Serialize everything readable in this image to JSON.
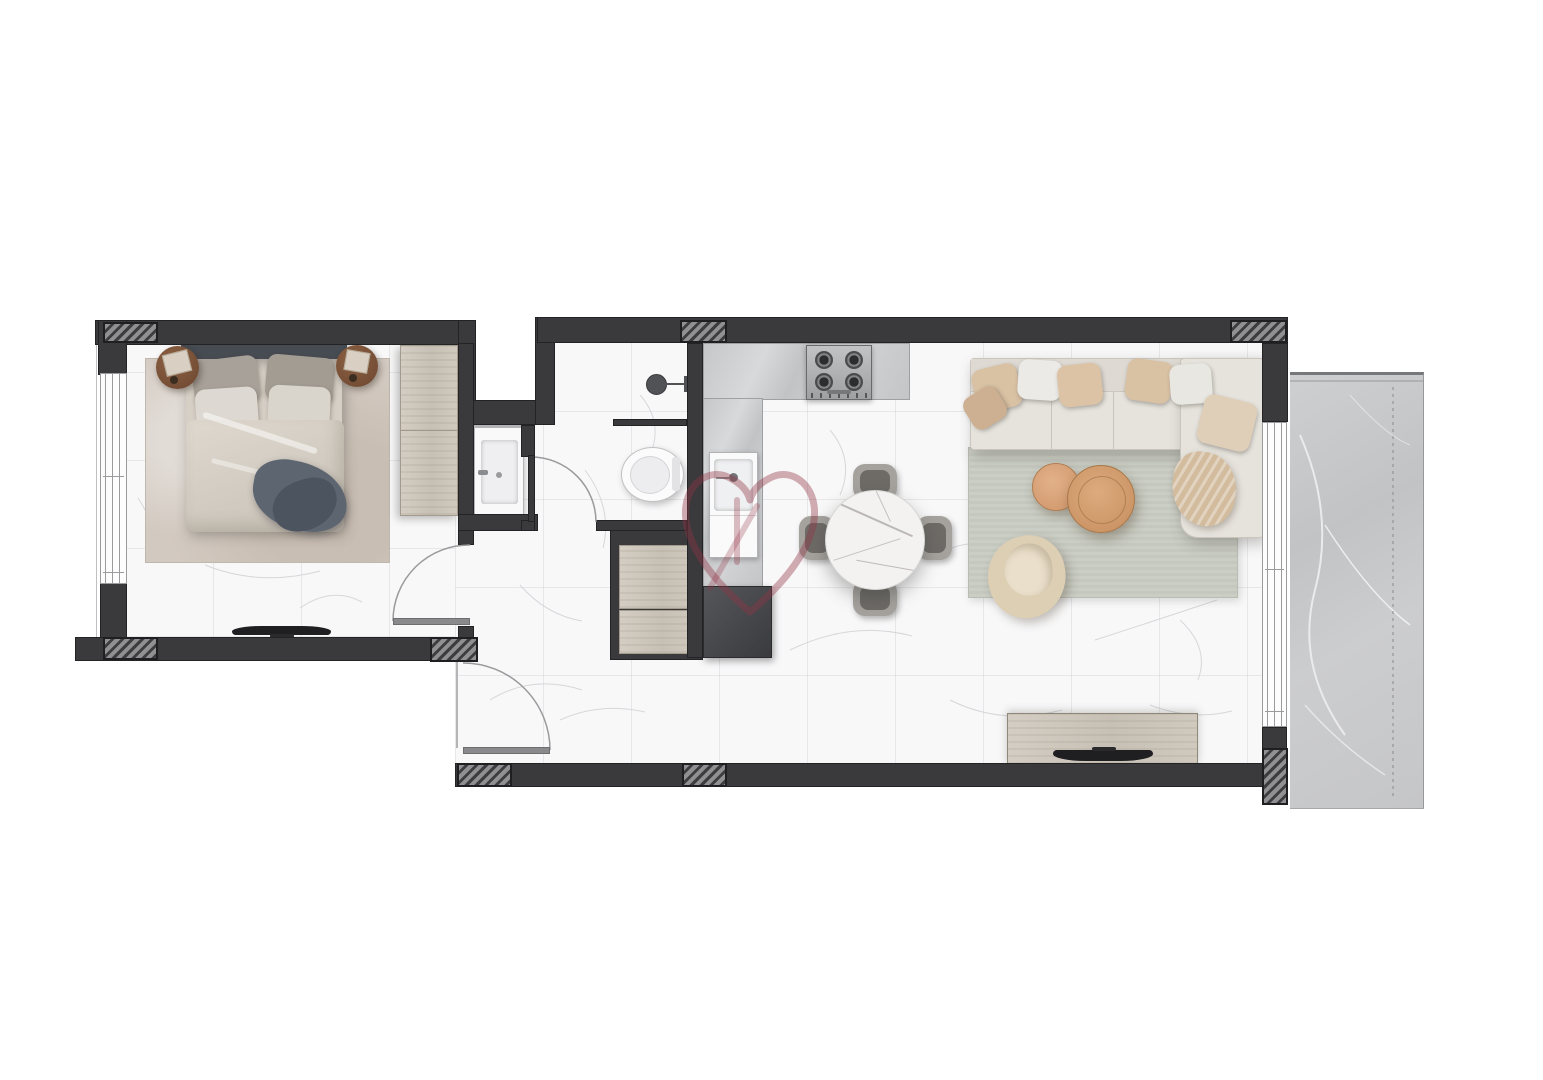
{
  "page": {
    "type": "apartment-floor-plan-render",
    "background": "#ffffff",
    "orientation": "top-down"
  },
  "watermark": {
    "name": "heart-outline-logo",
    "color": "#943448",
    "opacity": 0.4,
    "position": "center-of-plan"
  },
  "palette": {
    "wall": "#3a3a3c",
    "wall_outline": "#232325",
    "hatch_base": "#909092",
    "hatch_stripe": "#3d3d3f",
    "floor_marble_white": "#f8f8f9",
    "floor_grid_line": "#dcdce0",
    "floor_vein": "#d4d4d7",
    "balcony_marble_gray": "#c9c9cb",
    "balcony_vein": "#eeeef0",
    "counter_marble": "#c6c7c9",
    "wood_light": "#cfc8bd",
    "appliance_dark": "#46474b",
    "stainless": "#b9babc",
    "sofa_cream": "#e6e3dd",
    "pillow_beige": "#d9c1a4",
    "pillow_white": "#eceae6",
    "rug_living_gray_green": "#cbcec5",
    "rug_bedroom_beige": "#d2c9c0",
    "coffee_table_tan": "#d9a87c",
    "armchair_beige": "#ddcfb4",
    "dining_chair_gray": "#a5a29d",
    "dining_table_marble": "#f3f2f1",
    "bed_duvet": "#d8d2c9",
    "bed_headboard": "#474b52",
    "throw_blanket_slate": "#5d6570",
    "nightstand_brown": "#7a5136",
    "tv_black": "#1f1f21",
    "door_leaf_gray": "#8a8a8c"
  },
  "rooms": {
    "bedroom": {
      "name": "bedroom",
      "furniture": [
        "double-bed",
        "headboard",
        "pillows",
        "duvet",
        "throw-blanket",
        "nightstand-left",
        "nightstand-right",
        "area-rug",
        "wardrobe",
        "wall-tv"
      ],
      "openings": [
        "window-left-wall",
        "swing-door-bottom-right"
      ]
    },
    "bathroom": {
      "name": "bathroom",
      "fixtures": [
        "vanity-sink",
        "shower-head",
        "shower-half-wall",
        "toilet",
        "swing-door"
      ],
      "features": [
        "service-duct-notch"
      ]
    },
    "hallway": {
      "name": "entry-hallway",
      "fixtures": [
        "washer-dryer-stack",
        "entry-swing-door"
      ]
    },
    "kitchen": {
      "name": "kitchen",
      "fixtures": [
        "l-shaped-marble-counter",
        "gas-stove-4-burners",
        "kitchen-sink",
        "dark-base-appliance"
      ]
    },
    "living_dining": {
      "name": "open-living-dining",
      "furniture": [
        "round-marble-dining-table",
        "dining-chair-top",
        "dining-chair-right",
        "dining-chair-bottom",
        "dining-chair-left",
        "l-shaped-sectional-sofa",
        "sofa-pillows",
        "chaise-blanket",
        "coffee-table-small",
        "coffee-table-large",
        "swivel-armchair",
        "area-rug",
        "tv-console",
        "tv"
      ],
      "openings": [
        "sliding-window-right-wall"
      ]
    },
    "balcony": {
      "name": "balcony",
      "floor": "gray-marble",
      "features": [
        "expansion-dashed-line"
      ]
    }
  },
  "structure": {
    "wall_columns_hatched": 8,
    "doors": [
      "bedroom-door",
      "bathroom-door",
      "entry-door"
    ],
    "windows": [
      "bedroom-window",
      "living-room-window"
    ]
  }
}
